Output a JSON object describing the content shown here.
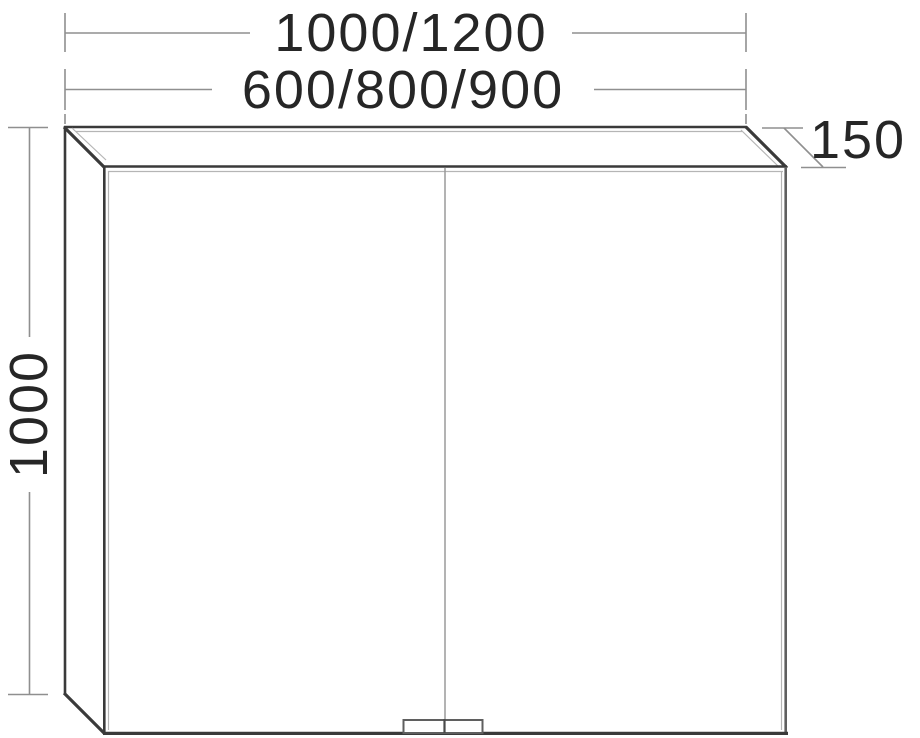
{
  "drawing": {
    "type": "technical-dimension-drawing",
    "subject": "two-door mirror wall cabinet, front elevation with depth projection",
    "labels": {
      "width_outer": "1000/1200",
      "width_inner": "600/800/900",
      "height": "1000",
      "depth": "150"
    },
    "colors": {
      "background": "#ffffff",
      "line_dark": "#3a3a3a",
      "line_medium": "#5f5f5f",
      "line_light": "#b5b5b5",
      "line_dimension": "#8f8f8f",
      "line_divider": "#9a9a9a",
      "label_text": "#262626"
    }
  }
}
